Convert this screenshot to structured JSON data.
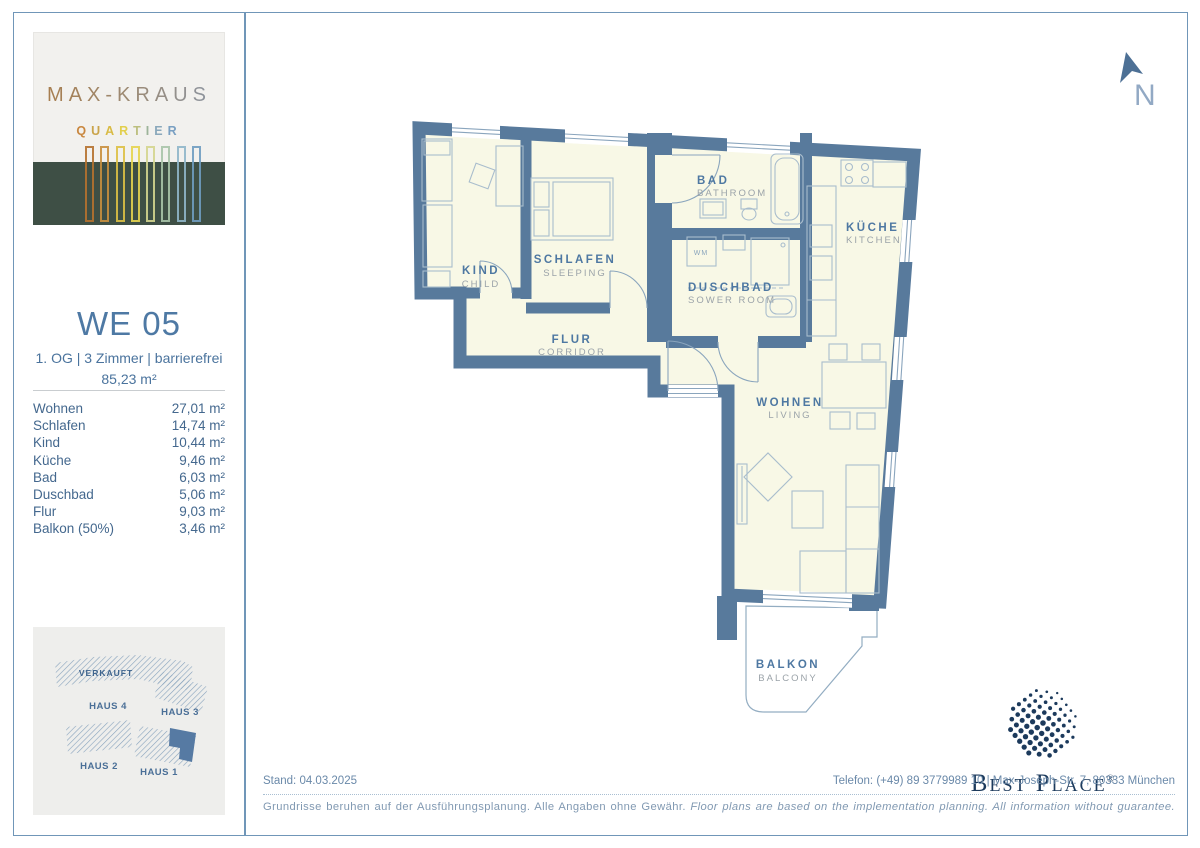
{
  "page": {
    "border_color": "#7096b8"
  },
  "sidebar": {
    "logo": {
      "title": "MAX-KRAUS",
      "subtitle": "QUARTIER",
      "subtitle_colors": [
        "#c9873f",
        "#caa44a",
        "#d9bb45",
        "#e2cf4d",
        "#bcbf7e",
        "#9db49a",
        "#8aa8bb",
        "#7aa0c2"
      ],
      "bar_colors": [
        "#b5712e",
        "#c98f3d",
        "#ddc044",
        "#e6d44e",
        "#d4d58e",
        "#a8c4a8",
        "#8fb6c9",
        "#6f9cc0"
      ],
      "band_color": "#3e4f45"
    },
    "unit": {
      "title": "WE 05",
      "subtitle": "1. OG | 3 Zimmer | barrierefrei",
      "total_area": "85,23 m²"
    },
    "rooms": [
      {
        "label": "Wohnen",
        "value": "27,01 m²"
      },
      {
        "label": "Schlafen",
        "value": "14,74 m²"
      },
      {
        "label": "Kind",
        "value": "10,44 m²"
      },
      {
        "label": "Küche",
        "value": "9,46 m²"
      },
      {
        "label": "Bad",
        "value": "6,03 m²"
      },
      {
        "label": "Duschbad",
        "value": "5,06 m²"
      },
      {
        "label": "Flur",
        "value": "9,03 m²"
      },
      {
        "label": "Balkon (50%)",
        "value": "3,46 m²"
      }
    ],
    "site_map": {
      "sold_label": "VERKAUFT",
      "haus4": "HAUS 4",
      "haus3": "HAUS 3",
      "haus2": "HAUS 2",
      "haus1": "HAUS 1",
      "highlight_color": "#567aa3"
    }
  },
  "plan": {
    "north_label": "N",
    "colors": {
      "wall": "#587a9c",
      "floor": "#f8f8e6",
      "line": "#a9bdcd"
    },
    "rooms": {
      "kind": {
        "de": "KIND",
        "en": "CHILD"
      },
      "schlafen": {
        "de": "SCHLAFEN",
        "en": "SLEEPING"
      },
      "bad": {
        "de": "BAD",
        "en": "BATHROOM"
      },
      "duschbad": {
        "de": "DUSCHBAD",
        "en": "SOWER ROOM"
      },
      "kueche": {
        "de": "KÜCHE",
        "en": "KITCHEN"
      },
      "flur": {
        "de": "FLUR",
        "en": "CORRIDOR"
      },
      "wohnen": {
        "de": "WOHNEN",
        "en": "LIVING"
      },
      "balkon": {
        "de": "BALKON",
        "en": "BALCONY"
      }
    },
    "wm_label": "WM"
  },
  "footer": {
    "stand": "Stand: 04.03.2025",
    "contact": "Telefon: (+49) 89 3779989 10 | Max-Joseph-Str. 7, 80333 München",
    "disclaimer_de": "Grundrisse beruhen auf der Ausführungsplanung. Alle Angaben ohne Gewähr.",
    "disclaimer_en": "Floor plans are based on the implementation planning. All information without guarantee.",
    "brand": {
      "name": "Best Place",
      "reg": "®"
    }
  }
}
